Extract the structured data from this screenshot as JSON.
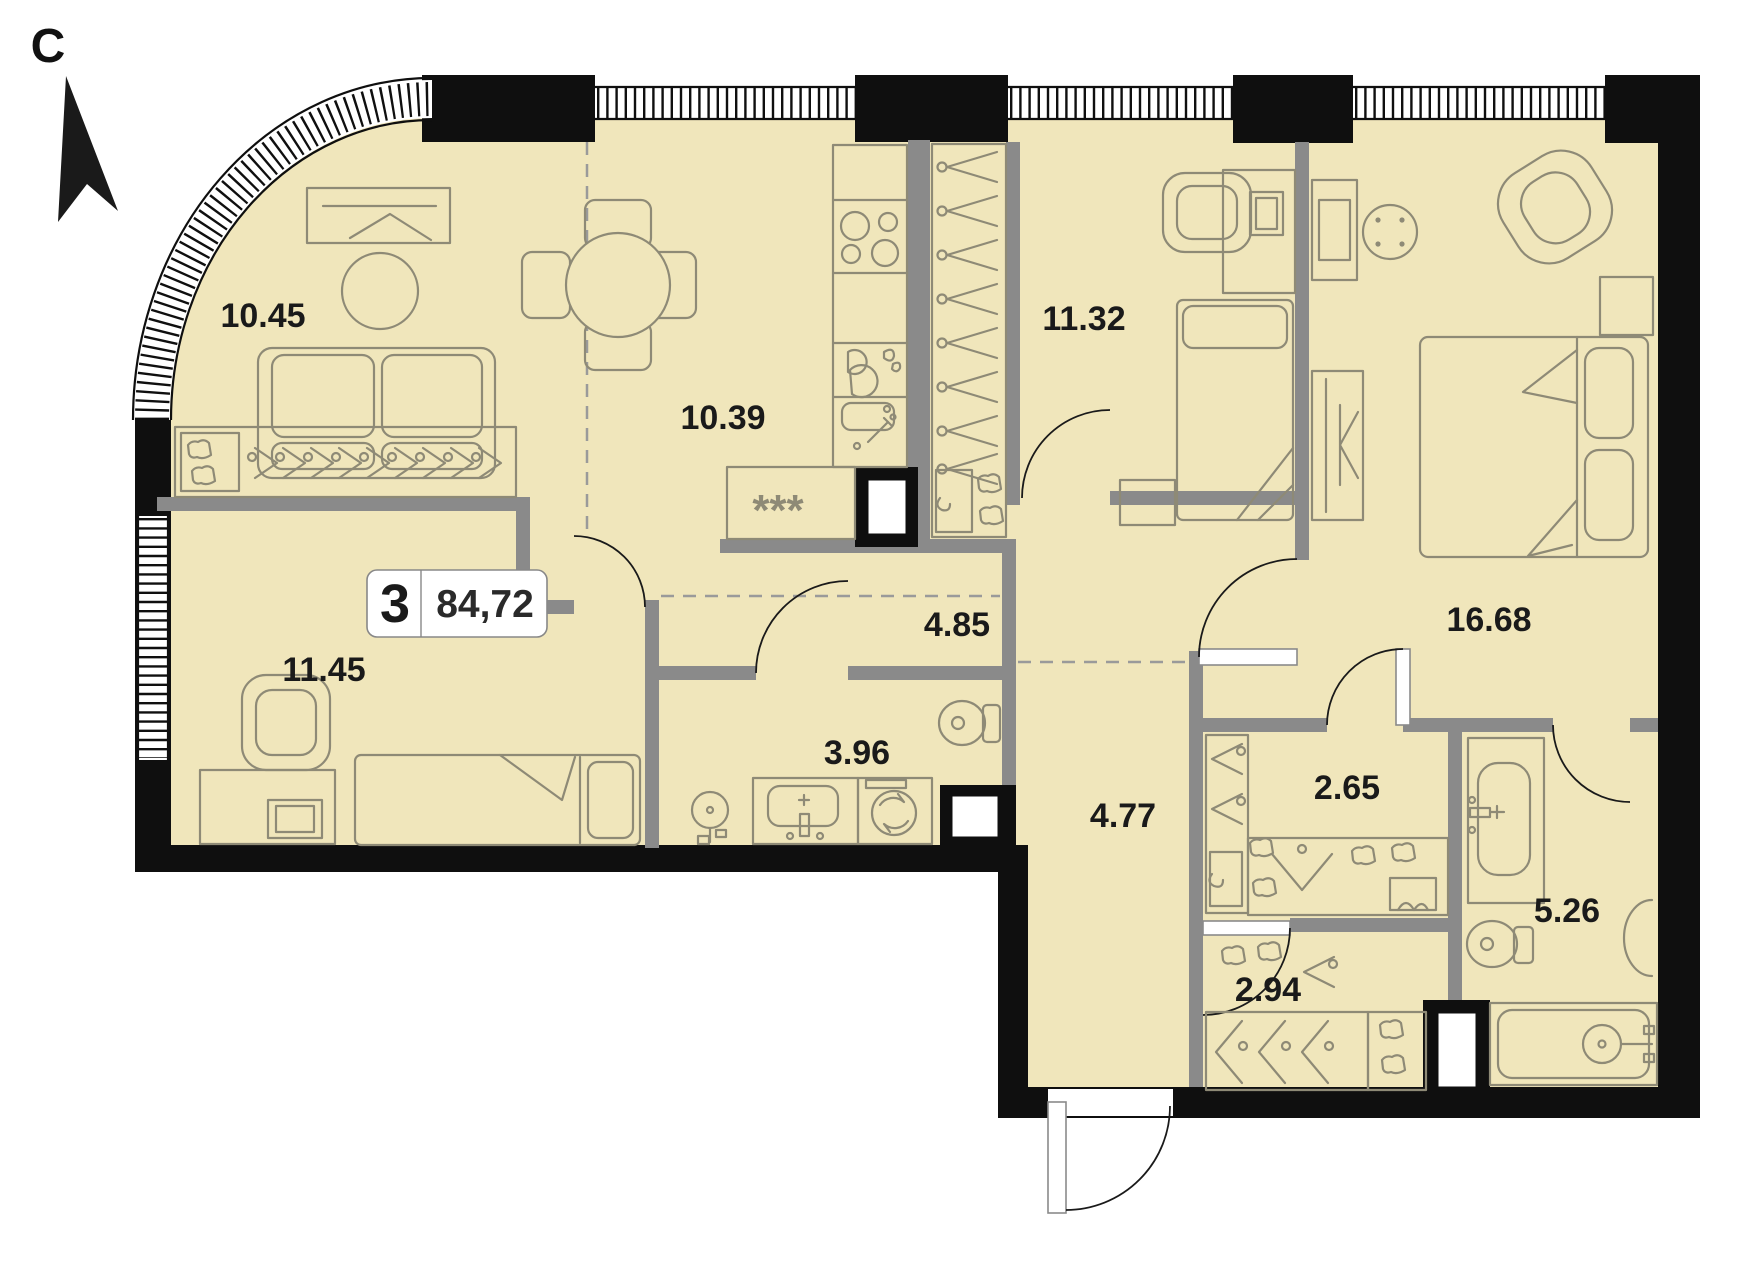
{
  "plan": {
    "north_label": "С",
    "badge": {
      "rooms_count": "3",
      "total_area": "84,72"
    },
    "kitchen_appliance_label": "***",
    "rooms": [
      {
        "id": "living-room",
        "area": "10.45"
      },
      {
        "id": "kitchen-dining",
        "area": "10.39"
      },
      {
        "id": "bedroom-top",
        "area": "11.32"
      },
      {
        "id": "master-bedroom",
        "area": "16.68"
      },
      {
        "id": "bedroom-left",
        "area": "11.45"
      },
      {
        "id": "hallway",
        "area": "4.85"
      },
      {
        "id": "bathroom-small",
        "area": "3.96"
      },
      {
        "id": "corridor",
        "area": "4.77"
      },
      {
        "id": "wardrobe-room",
        "area": "2.65"
      },
      {
        "id": "bathroom-large",
        "area": "5.26"
      },
      {
        "id": "storage-room",
        "area": "2.94"
      }
    ],
    "colors": {
      "floor_fill": "#f0e6bb",
      "exterior_wall": "#0f0f0f",
      "interior_wall": "#8a8a8a",
      "furniture_line": "#8e8a76",
      "label_text": "#1a1a1a"
    }
  }
}
